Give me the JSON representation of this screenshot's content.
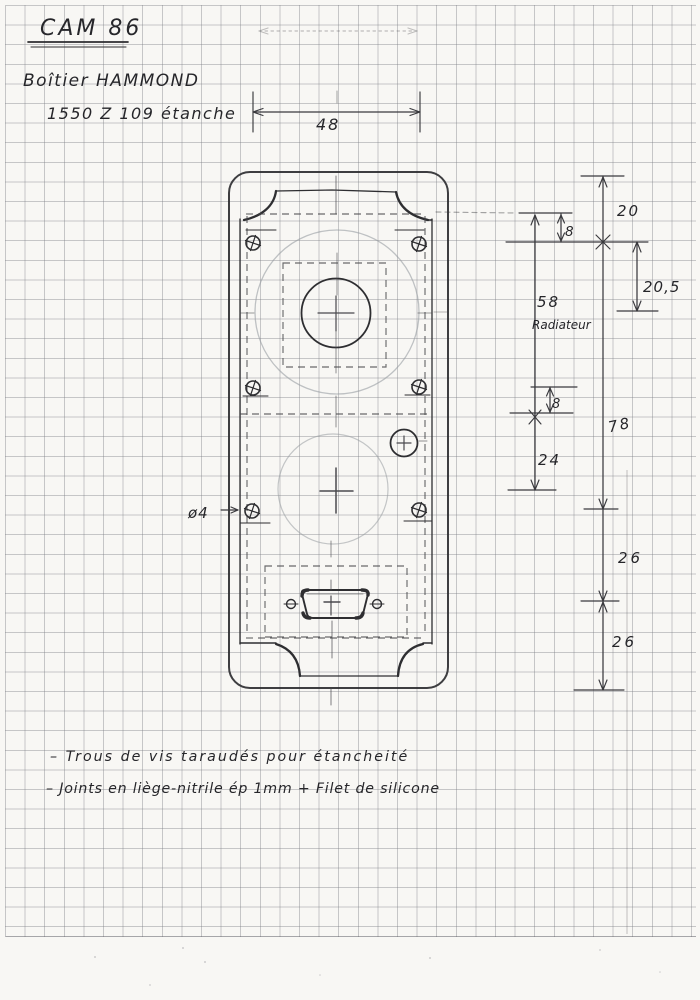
{
  "page": {
    "title": "CAM 86",
    "part_line1": "Boîtier HAMMOND",
    "part_line2": "1550 Z 109 étanche"
  },
  "dims": {
    "width_top": "48",
    "d20": "20",
    "d8_top": "8",
    "d205": "20,5",
    "d58": "58",
    "radiator": "Radiateur",
    "d8_mid": "8",
    "d78": "78",
    "d24": "24",
    "d26_upper": "26",
    "d26_lower": "26",
    "hole": "ø4"
  },
  "notes": {
    "line1": "– Trous de vis taraudés pour étancheité",
    "line2": "– Joints en liège-nitrile ép 1mm + Filet de silicone"
  }
}
